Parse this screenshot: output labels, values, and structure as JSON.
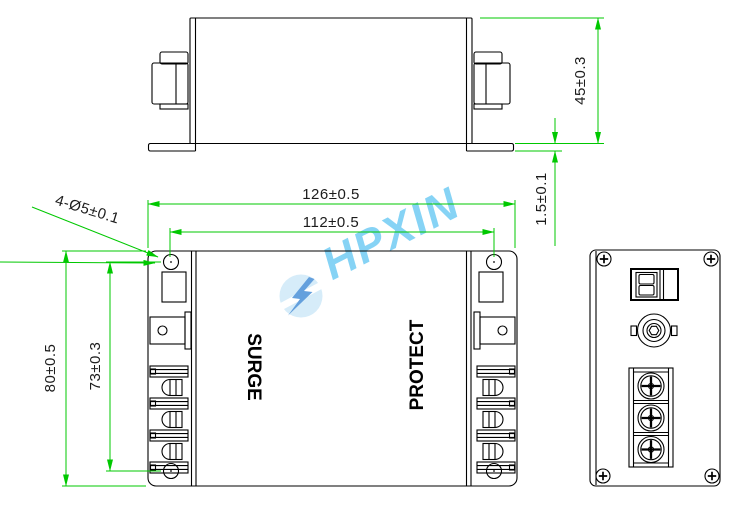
{
  "watermark": {
    "brand": "HPXIN",
    "icon": "lightning-bolt-icon",
    "text_color": "#72ccf4",
    "bolt_color": "#4a90d8",
    "badge_color": "#cfe9f8"
  },
  "colors": {
    "drawing_lines": "#000000",
    "dimension_lines": "#00c800",
    "dimension_text": "#1c1c1c",
    "background": "#ffffff"
  },
  "front_view": {
    "label_left": "SURGE",
    "label_right": "PROTECT"
  },
  "dimensions": {
    "overall_width": "126±0.5",
    "hole_spacing_horizontal": "112±0.5",
    "overall_height": "80±0.5",
    "hole_spacing_vertical": "73±0.3",
    "overall_depth": "45±0.3",
    "flange_thickness": "1.5±0.1",
    "mounting_holes": "4-Ø5±0.1"
  }
}
